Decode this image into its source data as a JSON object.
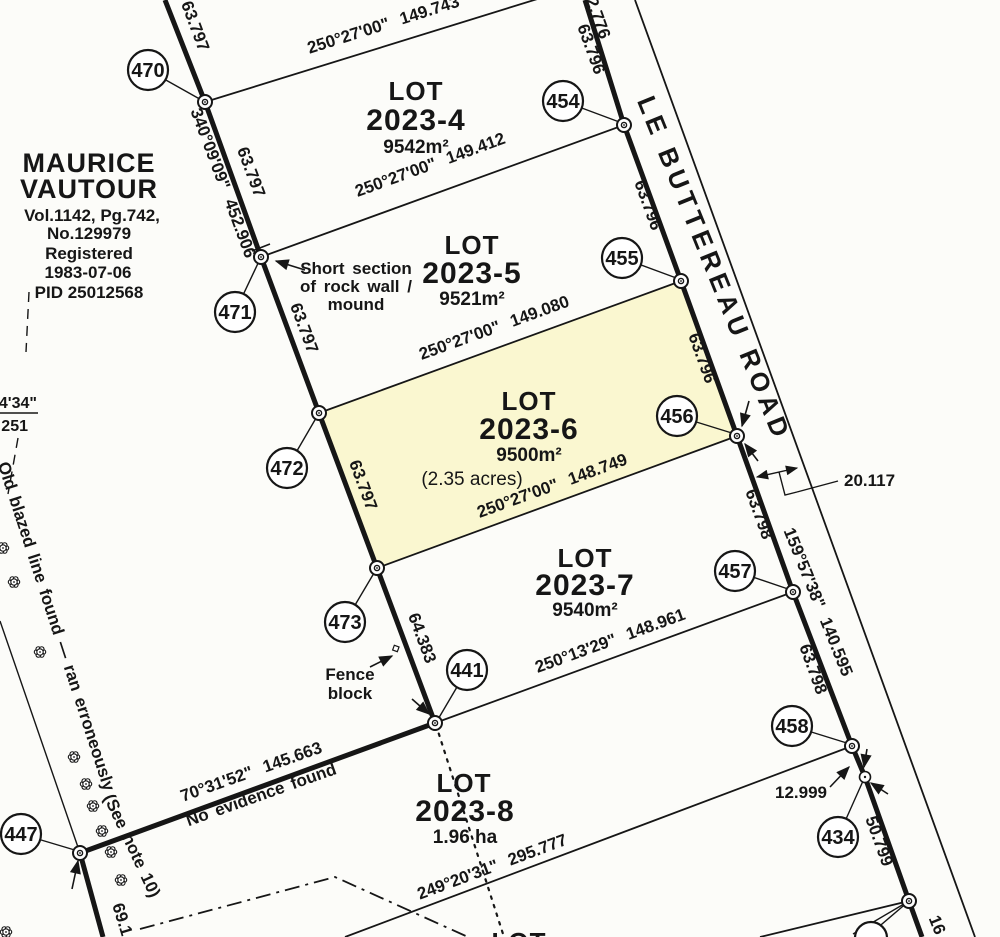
{
  "colors": {
    "paper": "#fcfcf9",
    "ink": "#161616",
    "highlight": "#faf7d0"
  },
  "title_block": {
    "name_line1": "MAURICE",
    "name_line2": "VAUTOUR",
    "vol": "Vol.1142, Pg.742,",
    "no": "No.129979",
    "registered": "Registered",
    "date": "1983-07-06",
    "pid": "PID 25012568"
  },
  "road": {
    "name": "LE BUTTEREAU ROAD",
    "offset_top": "2.776",
    "width_dim": "20.117",
    "offset_458_434": "12.999",
    "bearing_lower": "159°57'38\" 140.595",
    "bearing_bottom_partial": "16",
    "seg_top_454": "63.796",
    "seg_454_455": "63.796",
    "seg_455_456": "63.796",
    "seg_456_457": "63.798",
    "seg_457_458": "63.798",
    "seg_434_down": "50.799"
  },
  "west_line": {
    "bearing": "340°09'09\" 452.906",
    "seg_top_470": "63.797",
    "seg_470_471": "63.797",
    "seg_471_472": "63.797",
    "seg_472_473": "63.797",
    "seg_473_441": "64.383",
    "seg_bottom": "69.1",
    "partial_fraction_top": "4'34\"",
    "partial_fraction_bottom": "251"
  },
  "bearings": {
    "top": "250°27'00\" 149.743",
    "lot4_5": "250°27'00\" 149.412",
    "lot5_6": "250°27'00\" 149.080",
    "lot6_7": "250°27'00\" 148.749",
    "lot7_8": "250°13'29\" 148.961",
    "lot8_south": "249°20'31\" 295.777",
    "lot8_north": "70°31'52\" 145.663"
  },
  "lots": [
    {
      "label": "LOT",
      "number": "2023-4",
      "area": "9542m²"
    },
    {
      "label": "LOT",
      "number": "2023-5",
      "area": "9521m²"
    },
    {
      "label": "LOT",
      "number": "2023-6",
      "area": "9500m²",
      "area_acres": "(2.35 acres)"
    },
    {
      "label": "LOT",
      "number": "2023-7",
      "area": "9540m²"
    },
    {
      "label": "LOT",
      "number": "2023-8",
      "area": "1.96 ha"
    },
    {
      "label": "LOT"
    }
  ],
  "stations": [
    "470",
    "471",
    "472",
    "473",
    "441",
    "447",
    "454",
    "455",
    "456",
    "457",
    "458",
    "434"
  ],
  "notes": {
    "rock_wall_1": "Short section",
    "rock_wall_2": "of rock wall /",
    "rock_wall_3": "mound",
    "fence_1": "Fence",
    "fence_2": "block",
    "no_evidence": "No evidence found",
    "old_blazed": "Old blazed line found — ran erroneously",
    "see_note": "(See note 10)"
  }
}
